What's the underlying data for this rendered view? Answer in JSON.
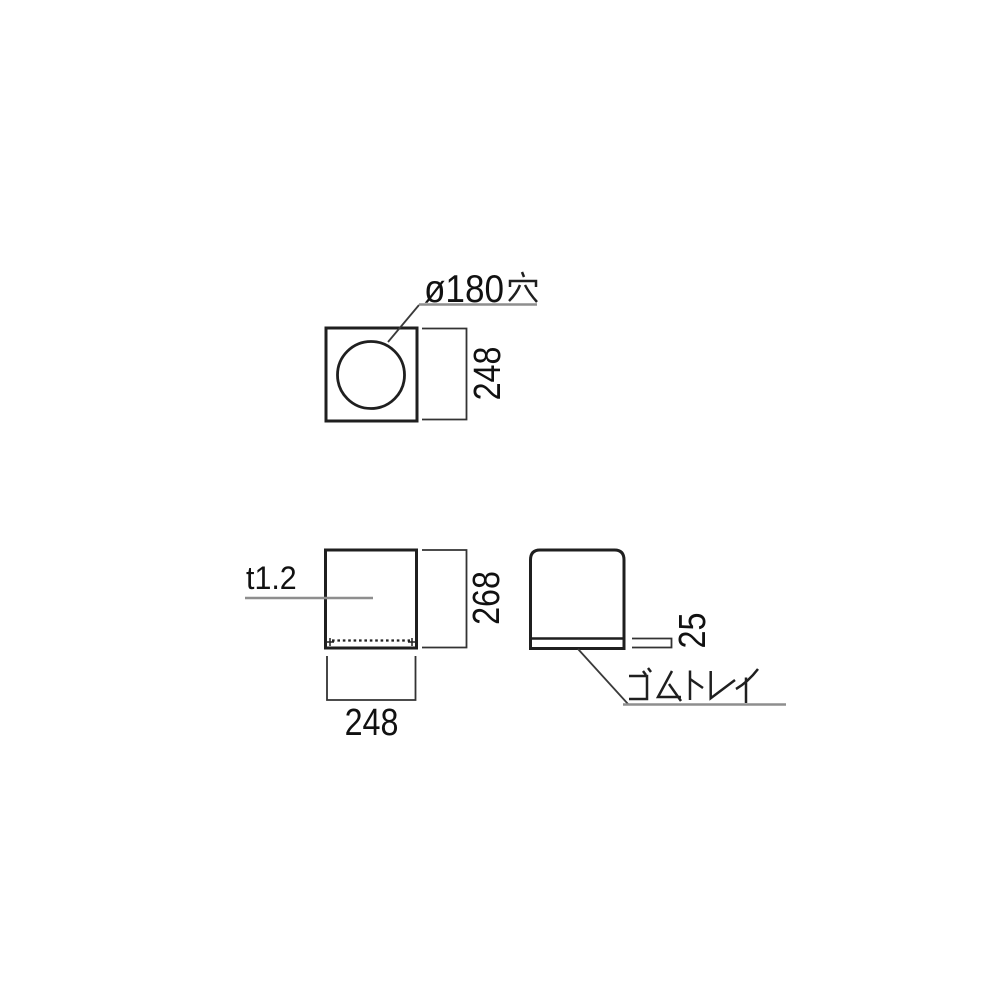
{
  "page": {
    "background": "#ffffff",
    "description": "technical-dimension-drawing"
  },
  "colors": {
    "outline": "#1f1f1f",
    "dimension_line": "#333333",
    "leader_line": "#8e8e8e",
    "text": "#111111"
  },
  "views": {
    "top": {
      "hole_label_full": "ø180穴",
      "hole_label_ascii": "ø180",
      "hole_label_kanji": "穴",
      "height_dim": "248"
    },
    "front": {
      "thickness_label": "t1.2",
      "height_dim": "268",
      "width_dim": "248"
    },
    "side": {
      "tray_height_dim": "25",
      "tray_label": "ゴムトレイ"
    }
  }
}
